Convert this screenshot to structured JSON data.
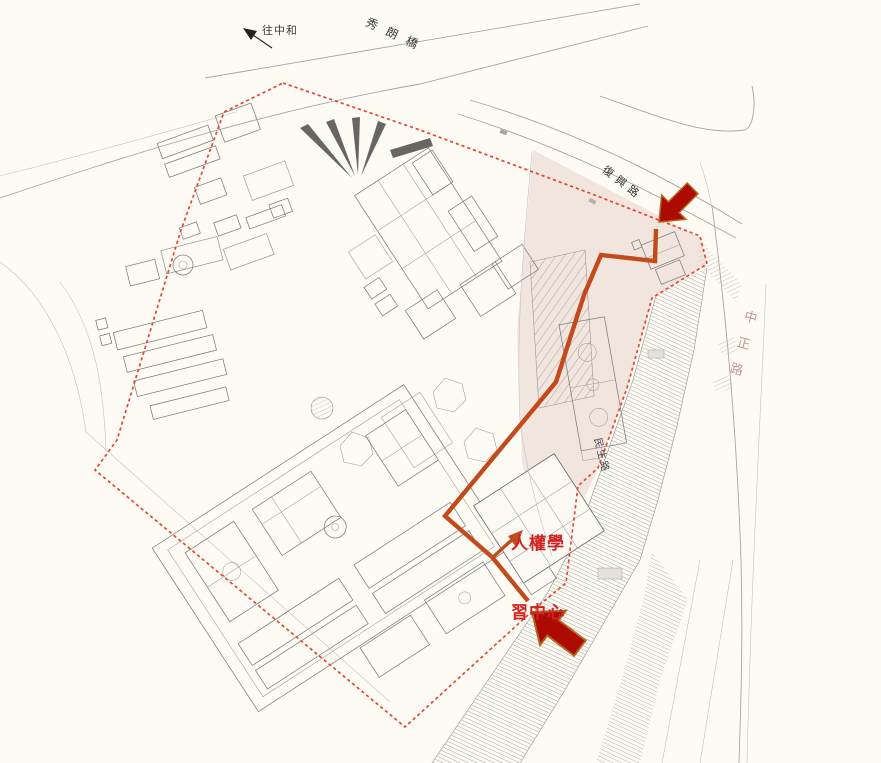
{
  "colors": {
    "paper": "#fdfbf4",
    "boundary_red": "#e2482f",
    "route_orange": "#c24a1b",
    "arrow_red": "#ad0a01",
    "arrow_outline": "#b3671c",
    "pink_zone": "#e8cfc8",
    "road_label": "#3a3a3a",
    "east_road_label": "#c29a91",
    "destination_red": "#d02421"
  },
  "labels": {
    "direction_note": "往中和",
    "bridge_name": "秀朗橋",
    "north_road": "復興路",
    "east_road": "中正路",
    "southeast_road": "民生路",
    "destination": {
      "line1": "人權學",
      "line2": "習中心"
    }
  },
  "icons": {
    "north_entrance_arrow": "large-red-arrow-pointing-southwest",
    "south_entrance_arrow": "large-red-arrow-pointing-northwest",
    "direction_arrow": "small-black-arrow-pointing-northwest",
    "route_arrow": "orange-arrowhead-to-destination"
  }
}
